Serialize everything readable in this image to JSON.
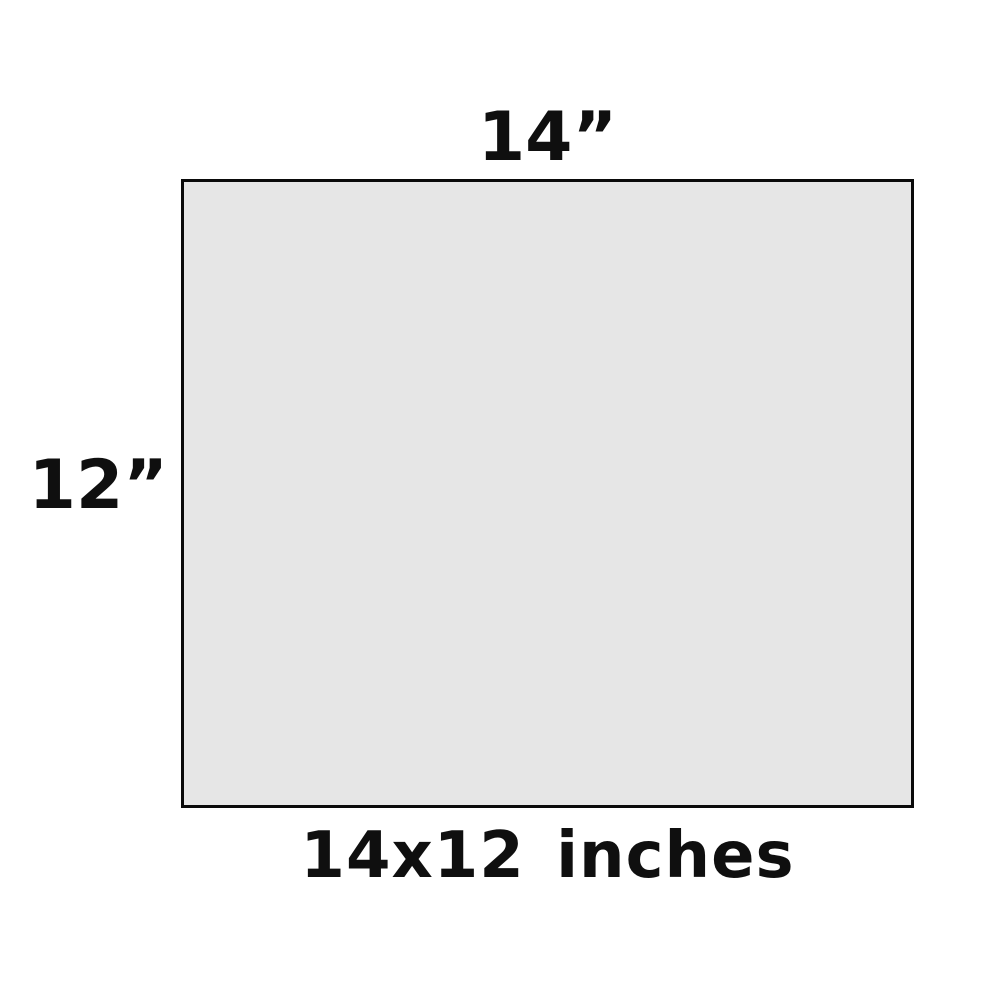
{
  "diagram": {
    "background_color": "#ffffff",
    "top_label": "14”",
    "left_label": "12”",
    "bottom_label": "14x12 inches",
    "rectangle": {
      "width_inches": 14,
      "height_inches": 12,
      "fill_color": "#e6e6e6",
      "border_color": "#0a0a0a",
      "label_color": "#0f0f0f"
    }
  }
}
